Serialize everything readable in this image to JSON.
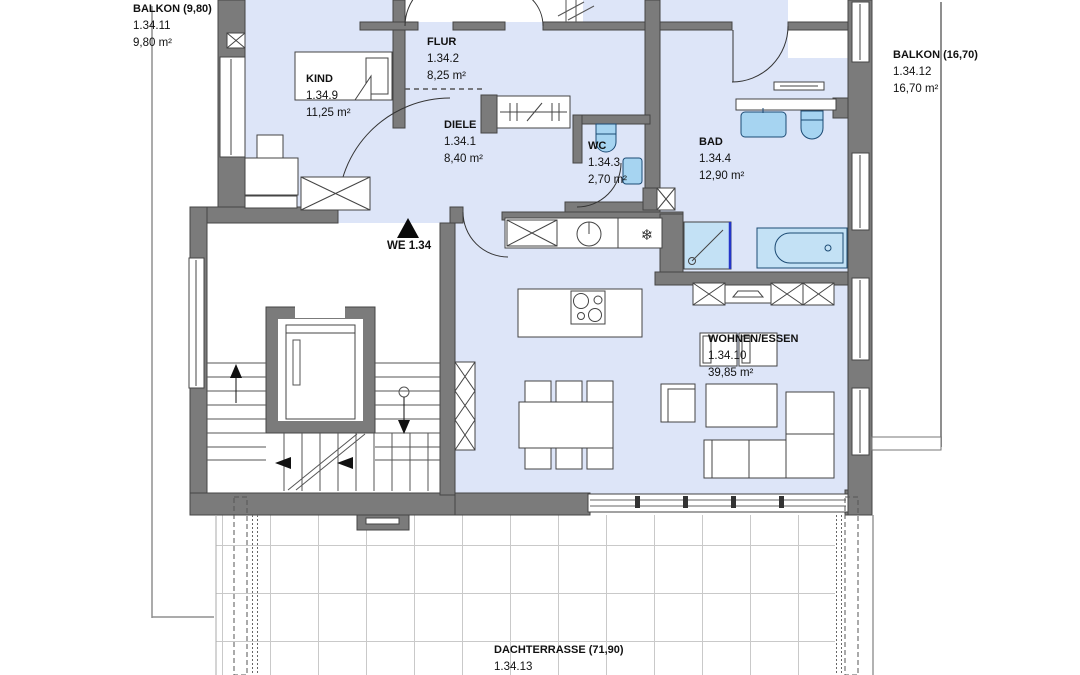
{
  "plan": {
    "title": "Wohnung WE 1.34 Grundriss",
    "unit_marker": "WE 1.34",
    "rooms": {
      "balkon_left": {
        "name": "BALKON (9,80)",
        "id": "1.34.11",
        "area": "9,80 m²"
      },
      "kind": {
        "name": "KIND",
        "id": "1.34.9",
        "area": "11,25 m²"
      },
      "flur": {
        "name": "FLUR",
        "id": "1.34.2",
        "area": "8,25 m²"
      },
      "diele": {
        "name": "DIELE",
        "id": "1.34.1",
        "area": "8,40 m²"
      },
      "wc": {
        "name": "WC",
        "id": "1.34.3",
        "area": "2,70 m²"
      },
      "bad": {
        "name": "BAD",
        "id": "1.34.4",
        "area": "12,90 m²"
      },
      "balkon_right": {
        "name": "BALKON (16,70)",
        "id": "1.34.12",
        "area": "16,70 m²"
      },
      "wohnen_essen": {
        "name": "WOHNEN/ESSEN",
        "id": "1.34.10",
        "area": "39,85 m²"
      },
      "dachterrasse": {
        "name": "DACHTERRASSE (71,90)",
        "id": "1.34.13"
      }
    },
    "colors": {
      "wall": "#7b7b7b",
      "floor": "#dde5f8",
      "fixture": "#a6d4f1",
      "fixture_light": "#c3e1f5",
      "fixture_stroke": "#1b4a74",
      "shower_accent": "#2436c9",
      "terrace_grid": "#c9c9c9"
    }
  }
}
